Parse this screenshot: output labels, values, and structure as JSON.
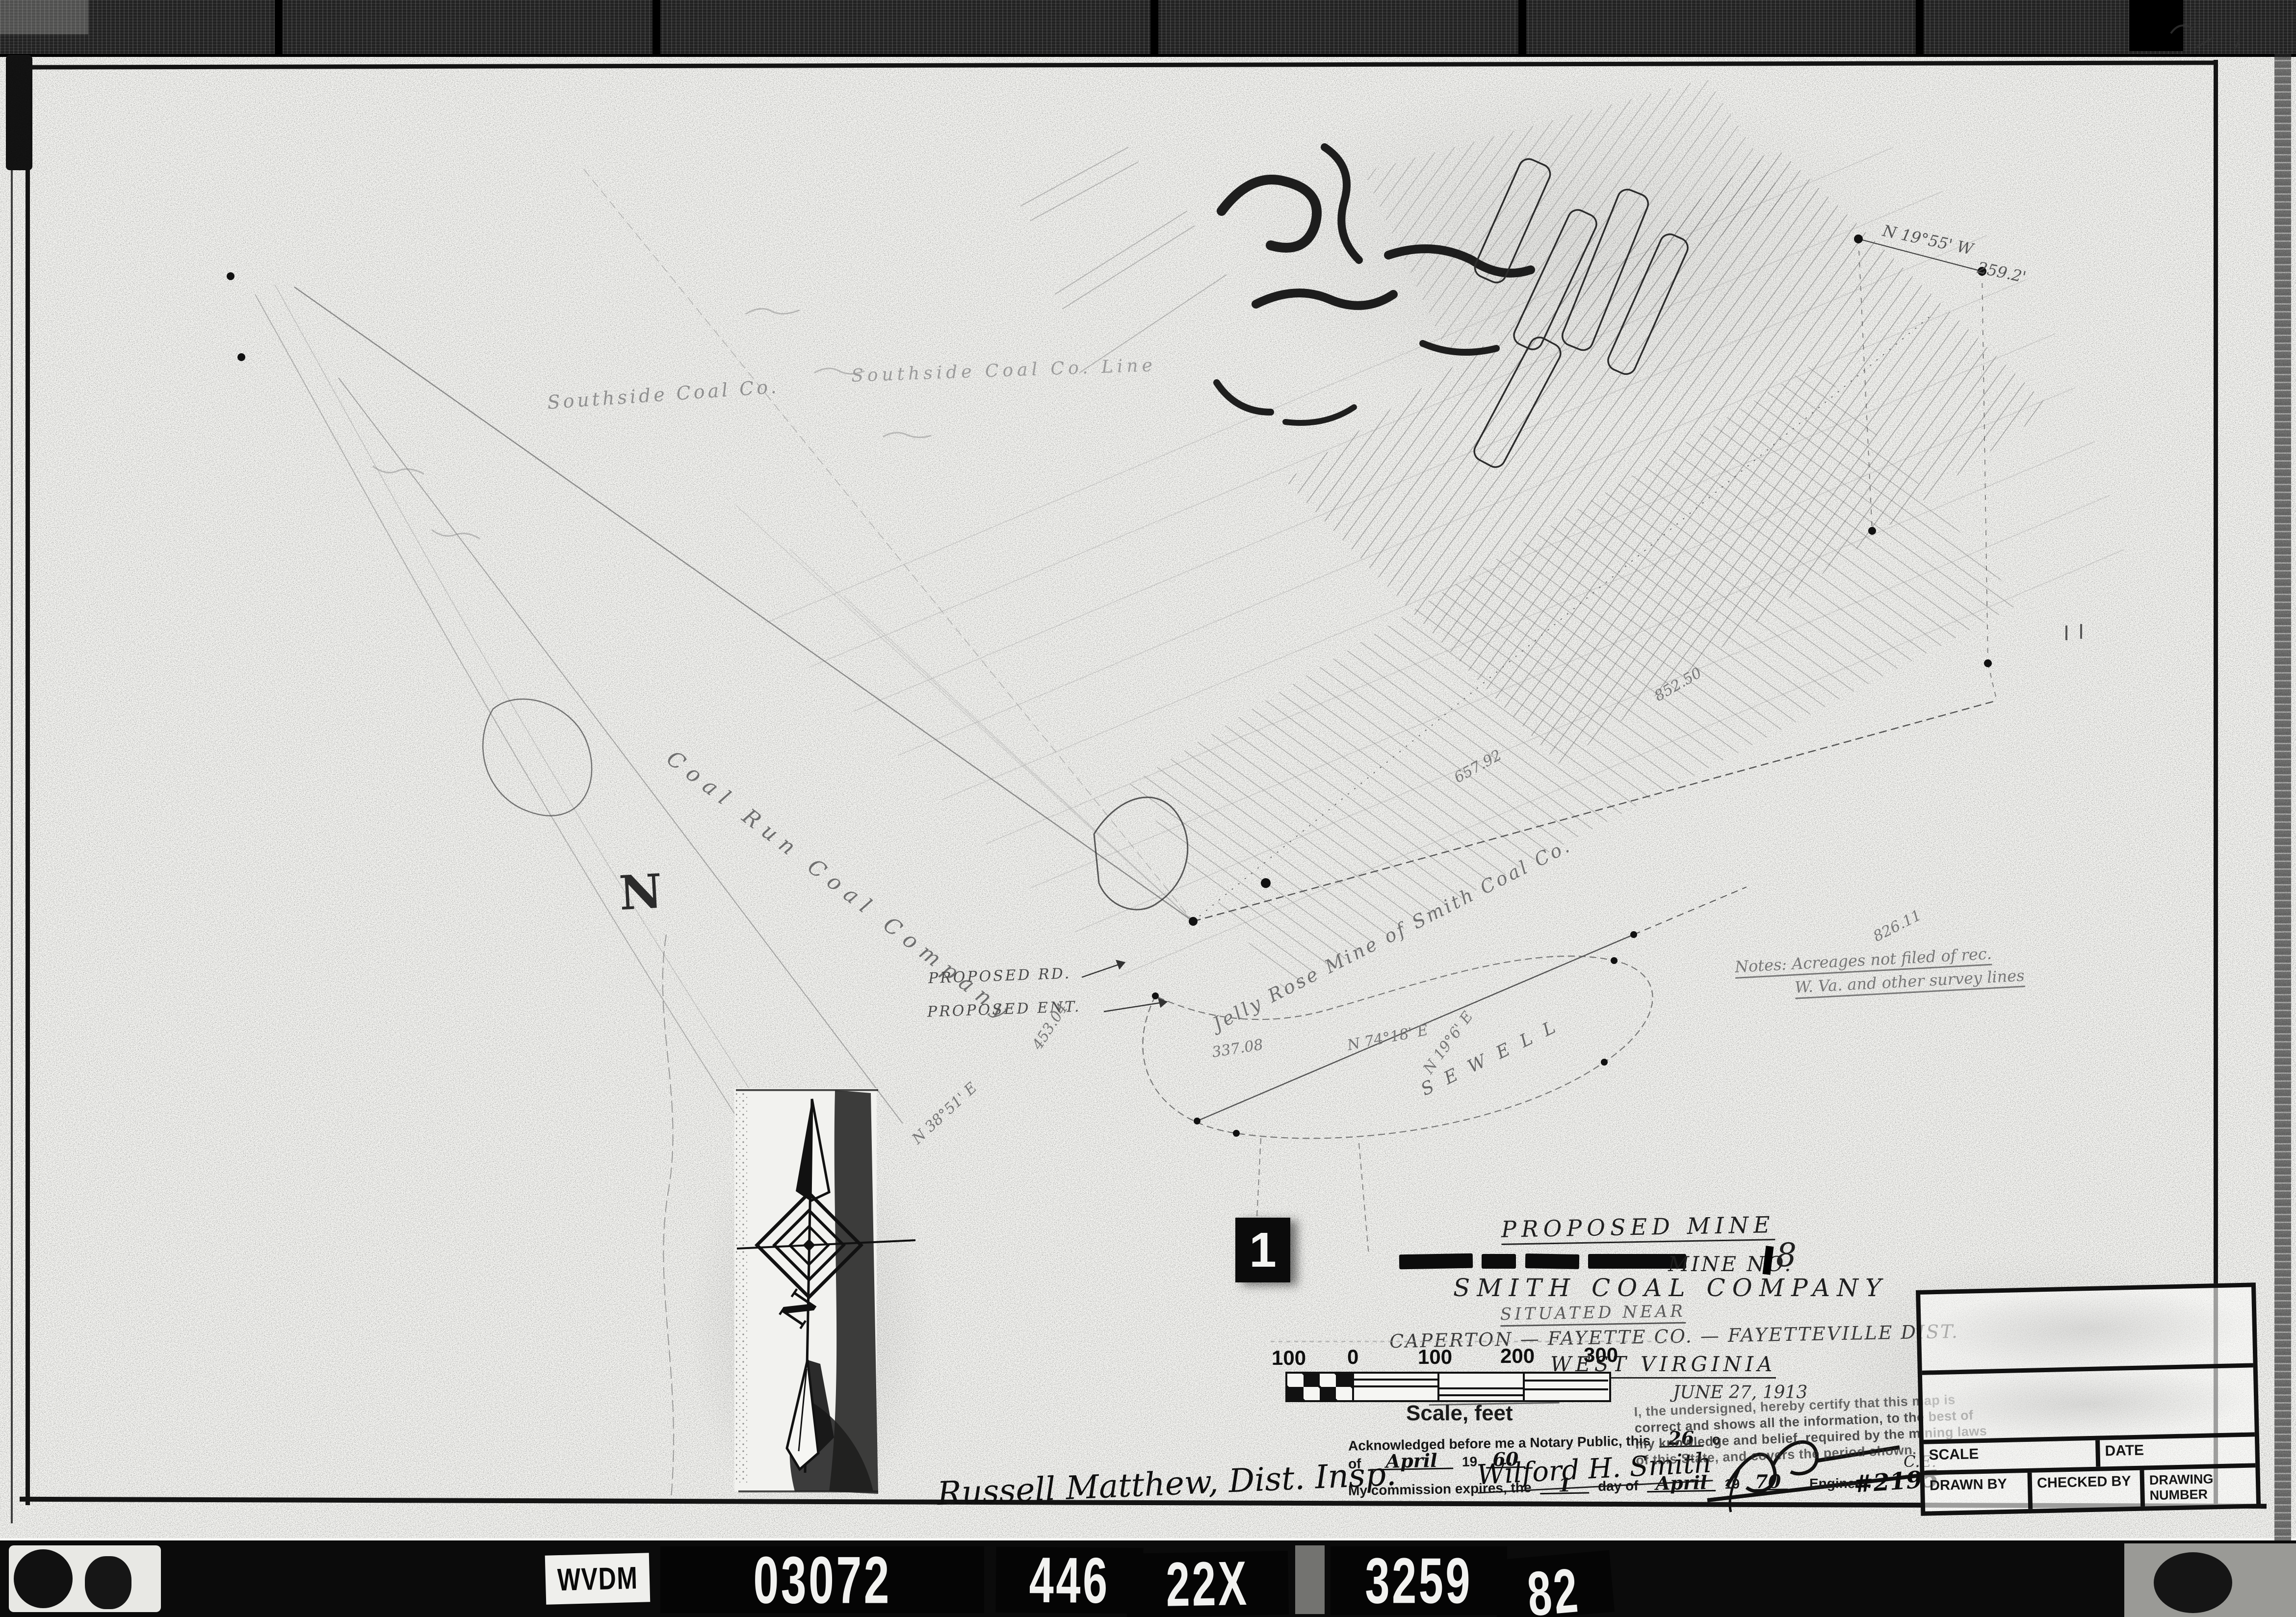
{
  "colors": {
    "paper": "#f6f6f3",
    "ink": "#161616",
    "pencil": "#8a8a8a",
    "film": "#0b0b0b"
  },
  "film_strip": {
    "agency_label": "WVDM",
    "frame_numbers": [
      "03072",
      "446",
      "22X",
      "3259",
      "82"
    ]
  },
  "frame_tag": "1",
  "map": {
    "labels": {
      "southside_line": "Southside Coal Co. Line",
      "southside": "Southside Coal Co.",
      "coal_run": "Coal Run Coal Company",
      "jelly_rose": "Jelly Rose Mine of Smith Coal Co.",
      "sewell": "S E W E L L",
      "proposed_rd": "PROPOSED RD.",
      "proposed_ent": "PROPOSED ENT.",
      "north_letter": "N",
      "notes_line1": "Notes: Acreages not filed of rec.",
      "notes_line2": "W. Va. and other survey lines"
    },
    "bearings": {
      "top_bearing": "N 19°55' W",
      "top_distance": "259.2'",
      "m826": "826.11",
      "m657": "657.92",
      "m852": "852.50",
      "m453": "453.04",
      "m337": "337.08",
      "b7418": "N 74°18' E",
      "b196": "N 19°6' E",
      "b3851": "N 38°51' E"
    }
  },
  "title_area": {
    "heading": "PROPOSED MINE",
    "mine_no_label": "MINE NO.",
    "mine_no_value": "8",
    "company": "SMITH COAL COMPANY",
    "situated": "SITUATED NEAR",
    "location": "CAPERTON — FAYETTE CO. — FAYETTEVILLE DIST.",
    "state": "WEST VIRGINIA",
    "scale_note": "Scale 1\" = 100'",
    "date": "JUNE 27, 1913"
  },
  "scale_bar": {
    "tick_labels": [
      "100",
      "0",
      "100",
      "200",
      "300"
    ],
    "caption": "Scale, feet"
  },
  "notary": {
    "ack_text": "Acknowledged before me a Notary Public, this",
    "ack_day": "26",
    "ack_suffix": "o",
    "of_label": "of",
    "ack_month": "April",
    "year_prefix": "19",
    "ack_year": "60",
    "notary_signature": "Wilford H. Smith",
    "expires_text": "My commission expires, the",
    "exp_day": "1",
    "day_of_label": "day of",
    "exp_month": "April",
    "exp_year": "70"
  },
  "certification": {
    "lines": [
      "I, the undersigned, hereby certify that this map is",
      "correct and shows all the information, to the best of",
      "my knowledge and belief, required by the mining laws",
      "of this State, and covers the period shown."
    ],
    "engineer_label": "Engineer.",
    "engineer_number": "#2195",
    "engineer_suffix": "C.E."
  },
  "title_block": {
    "scale_label": "SCALE",
    "date_label": "DATE",
    "drawn_by_label": "DRAWN BY",
    "checked_by_label": "CHECKED BY",
    "drawing_number_label": "DRAWING NUMBER"
  },
  "inspector_signature": "Russell Matthew, Dist. Insp."
}
